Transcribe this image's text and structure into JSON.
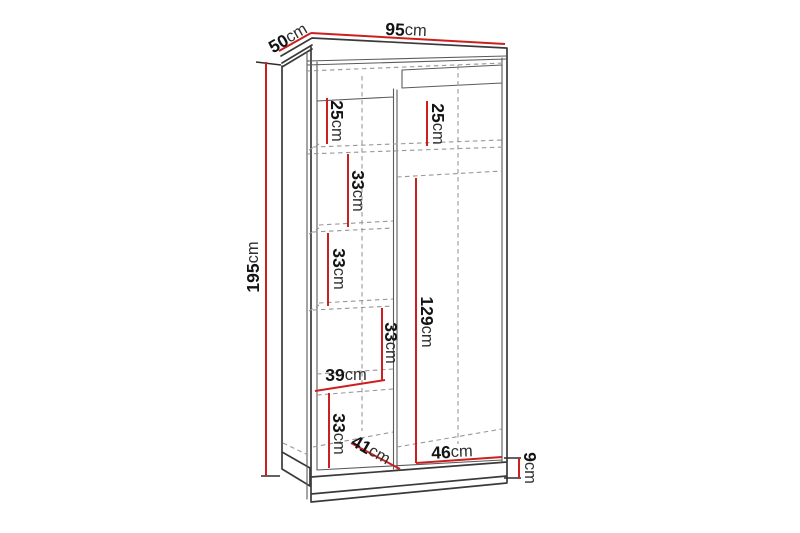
{
  "colors": {
    "background": "#ffffff",
    "dimension": "#cc2020",
    "outline": "#3a3a3a",
    "inner": "#5a5a5a",
    "hidden": "#979797",
    "tick": "#2e2e2e",
    "number": "#141414",
    "unit": "#2f2f2f"
  },
  "labels": {
    "depth": {
      "value": "50",
      "unit": "cm"
    },
    "width": {
      "value": "95",
      "unit": "cm"
    },
    "height": {
      "value": "195",
      "unit": "cm"
    },
    "left_top_shelf": {
      "value": "25",
      "unit": "cm"
    },
    "right_top_shelf": {
      "value": "25",
      "unit": "cm"
    },
    "left_shelf_1": {
      "value": "33",
      "unit": "cm"
    },
    "left_shelf_2": {
      "value": "33",
      "unit": "cm"
    },
    "left_shelf_3": {
      "value": "33",
      "unit": "cm"
    },
    "hanging_space": {
      "value": "129",
      "unit": "cm"
    },
    "left_shelf_width": {
      "value": "39",
      "unit": "cm"
    },
    "left_bottom_shelf": {
      "value": "33",
      "unit": "cm"
    },
    "bottom_depth": {
      "value": "41",
      "unit": "cm"
    },
    "right_bottom_width": {
      "value": "46",
      "unit": "cm"
    },
    "plinth_height": {
      "value": "9",
      "unit": "cm"
    }
  }
}
